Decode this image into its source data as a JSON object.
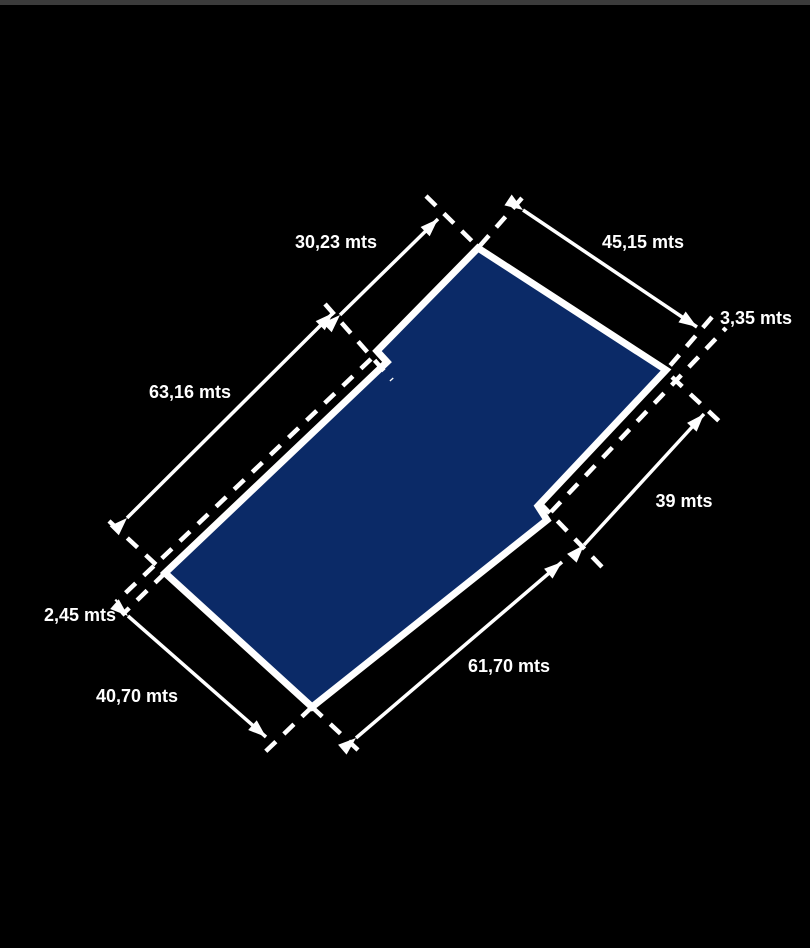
{
  "diagram": {
    "type": "land-parcel-survey",
    "unit": "mts",
    "measurements": {
      "top_left_edge": "30,23 mts",
      "top_right_edge": "45,15 mts",
      "right_corner_offset": "3,35 mts",
      "left_lower_edge": "63,16 mts",
      "right_edge": "39 mts",
      "bottom_left_corner_offset": "2,45 mts",
      "bottom_left_edge": "40,70 mts",
      "bottom_right_edge": "61,70 mts"
    },
    "colors": {
      "background": "#000000",
      "top_bar": "#3b3b3b",
      "parcel_fill": "#0b2a67",
      "line": "#ffffff"
    }
  }
}
